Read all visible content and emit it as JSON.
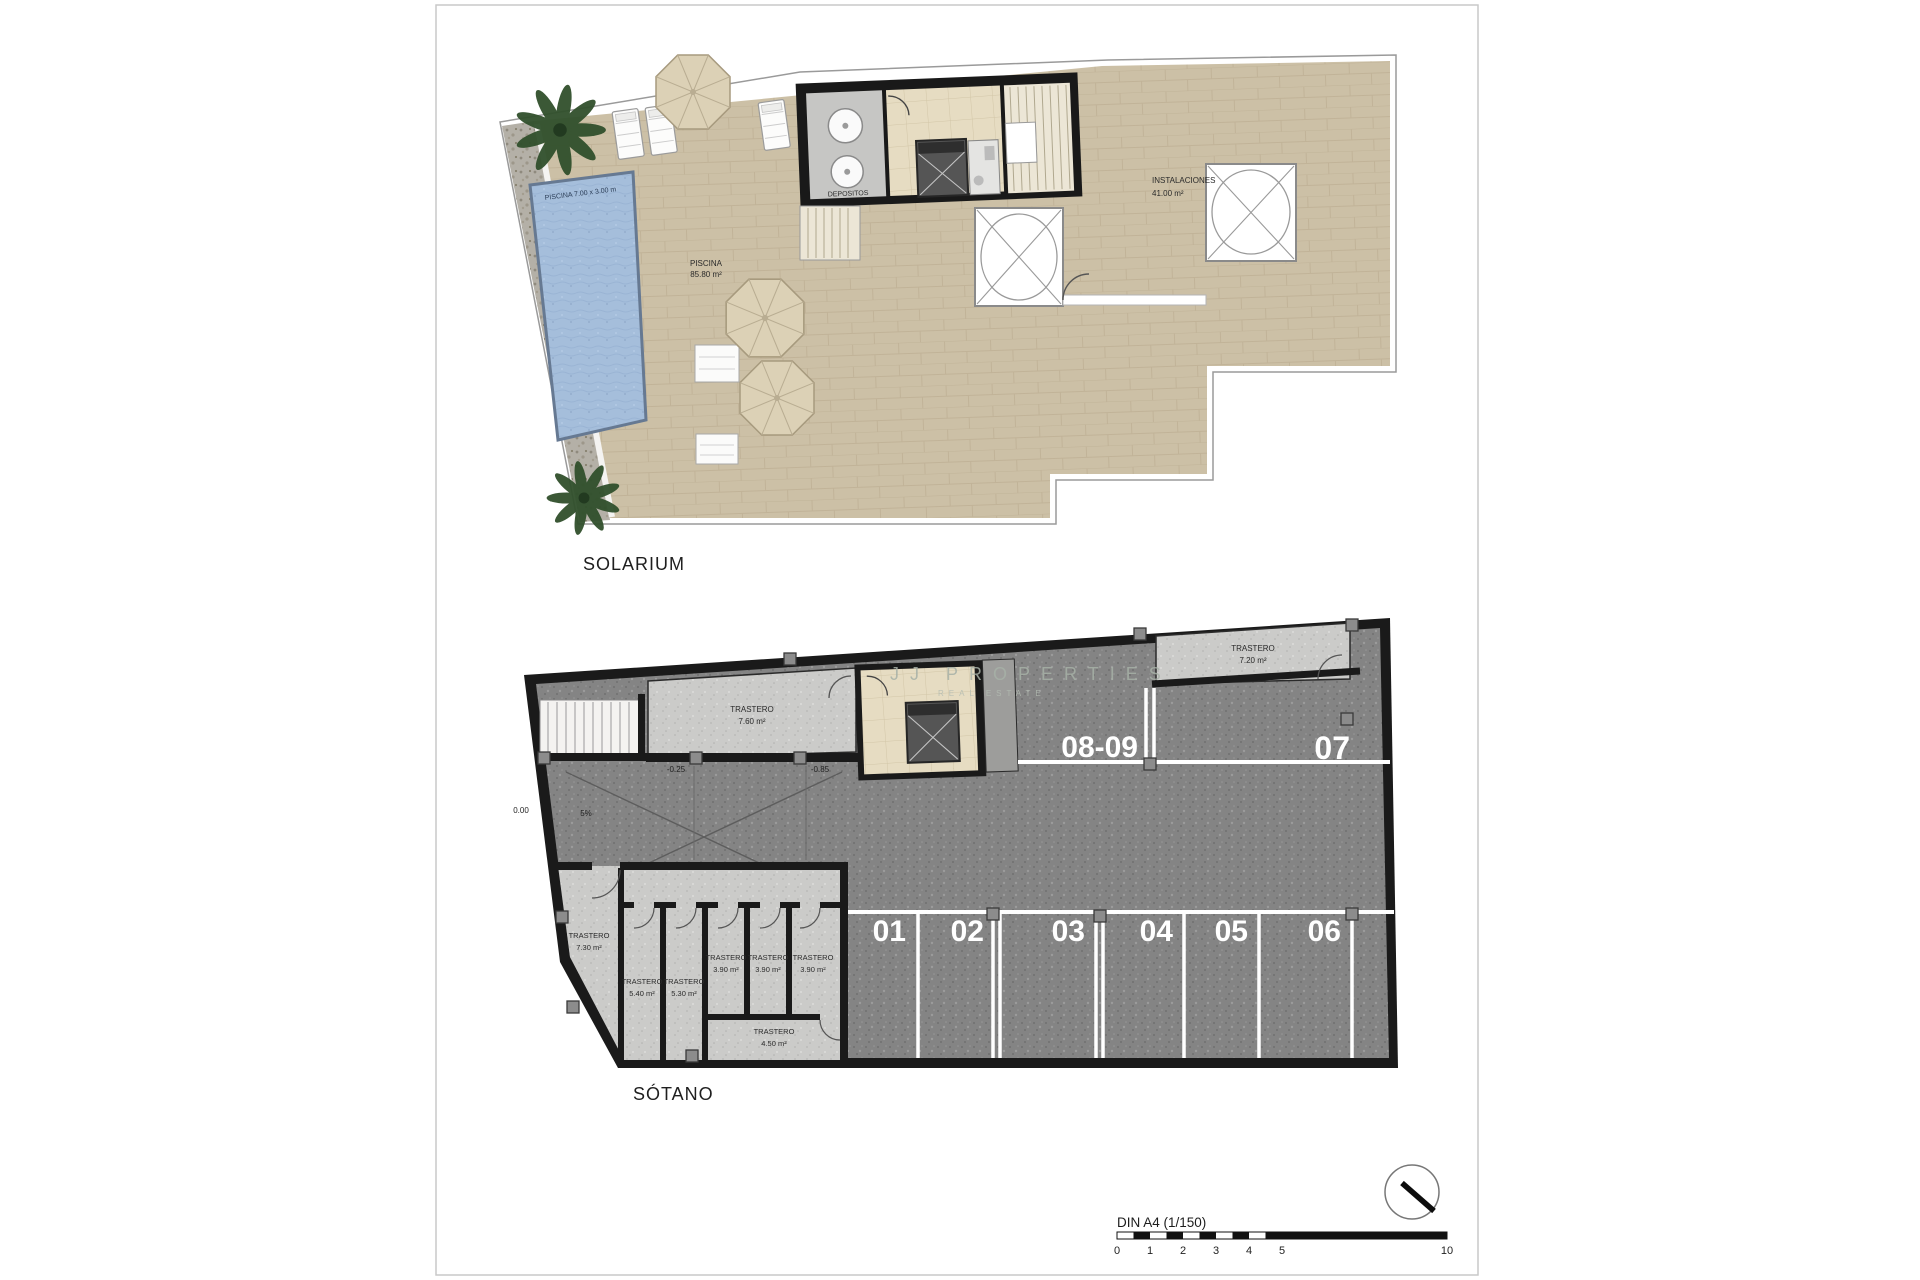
{
  "document": {
    "watermark_line1": "JJ PROPERTIES",
    "watermark_line2": "REAL ESTATE"
  },
  "solarium": {
    "title": "SOLARIUM",
    "pool_dimensions": "PISCINA 7.00 x 3.00 m",
    "pool_label": "PISCINA",
    "pool_area": "85.80 m²",
    "tanks_room_label": "DEPOSITOS",
    "installations_label": "INSTALACIONES",
    "installations_area": "41.00 m²"
  },
  "sotano": {
    "title": "SÓTANO",
    "parking": {
      "p1": "01",
      "p2": "02",
      "p3": "03",
      "p4": "04",
      "p5": "05",
      "p6": "06",
      "p7": "07",
      "p89": "08-09"
    },
    "levels": {
      "entry": "0.00",
      "slope": "5%",
      "mid": "-0.25",
      "low": "-0.85"
    },
    "storage": {
      "room_label": "TRASTERO",
      "areas": {
        "top": "7.60 m²",
        "top_right": "7.20 m²",
        "left": "7.30 m²",
        "r1": "5.40 m²",
        "r2": "5.30 m²",
        "r3": "3.90 m²",
        "r4": "3.90 m²",
        "r5": "3.90 m²",
        "r6": "4.50 m²"
      }
    }
  },
  "footer": {
    "scale_label": "DIN A4 (1/150)",
    "tick_0": "0",
    "tick_1": "1",
    "tick_2": "2",
    "tick_3": "3",
    "tick_4": "4",
    "tick_5": "5",
    "tick_10": "10"
  }
}
